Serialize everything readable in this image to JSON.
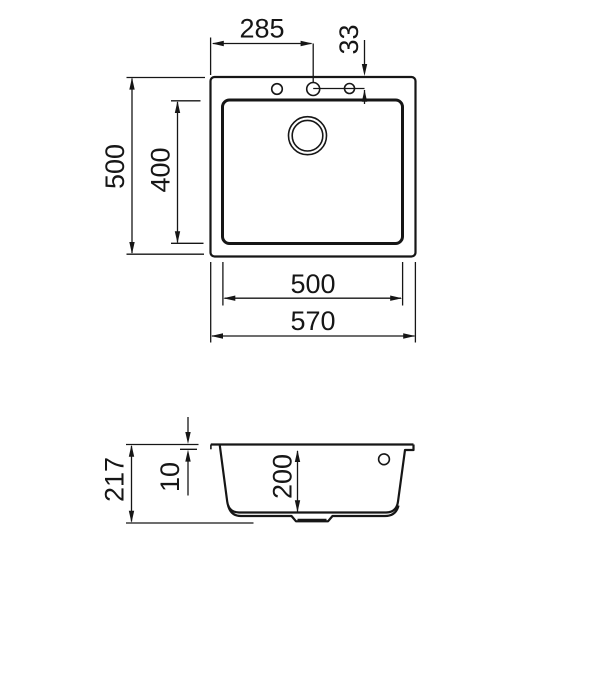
{
  "colors": {
    "line": "#161616",
    "background": "#ffffff"
  },
  "top_view": {
    "dims": {
      "faucet_offset_x": "285",
      "faucet_offset_y": "33",
      "overall_depth": "500",
      "bowl_inner_depth": "400",
      "bowl_inner_width": "500",
      "overall_width": "570"
    }
  },
  "side_view": {
    "dims": {
      "overall_height": "217",
      "rim_thickness": "10",
      "bowl_depth": "200"
    }
  }
}
